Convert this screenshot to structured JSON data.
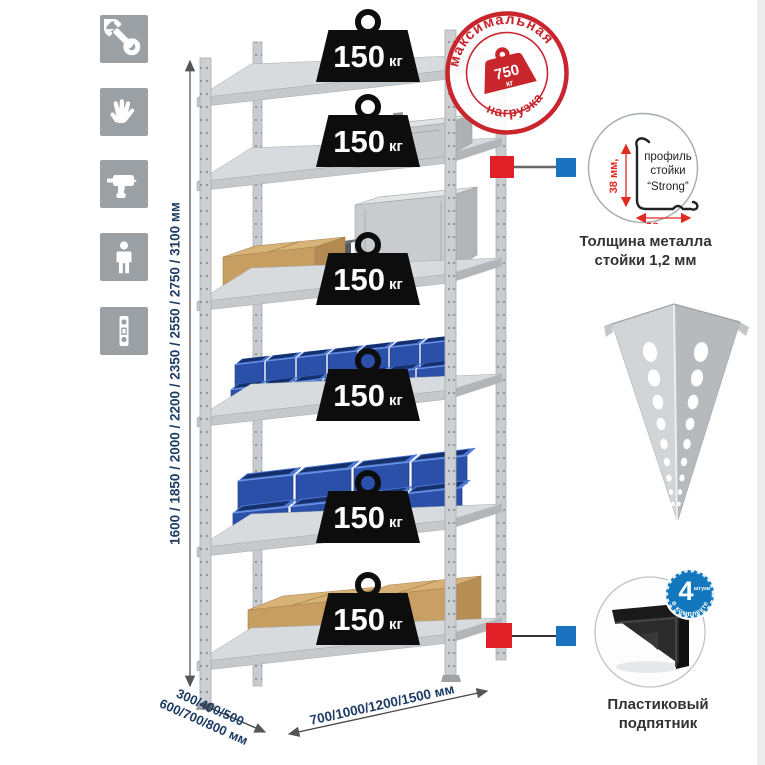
{
  "page": {
    "background": "#ffffff"
  },
  "sidebar": {
    "icons": [
      {
        "name": "wrench"
      },
      {
        "name": "work-gloves"
      },
      {
        "name": "drill"
      },
      {
        "name": "person"
      },
      {
        "name": "spirit-level"
      }
    ]
  },
  "rack": {
    "shelf_count": 6,
    "shelf_load_value": "150",
    "shelf_load_unit": "кг"
  },
  "max_load_stamp": {
    "arc_top": "максимальная",
    "arc_bottom": "нагрузка",
    "value": "750",
    "unit": "кг"
  },
  "dimensions": {
    "height": "1600 / 1850 / 2000 / 2200 / 2350 / 2550 / 2750 / 3100 мм",
    "depth_line1": "300/400/500",
    "depth_line2": "600/700/800 мм",
    "width": "700/1000/1200/1500 мм"
  },
  "profile_detail": {
    "label_line1": "профиль",
    "label_line2": "стойки",
    "label_line3": "“Strong”",
    "dim_vertical": "38 мм,",
    "dim_horizontal": "38 мм,",
    "caption_line1": "Толщина металла",
    "caption_line2": "стойки 1,2 мм"
  },
  "foot_detail": {
    "badge_value": "4",
    "badge_word": "штуки",
    "badge_arc": "в комплекте",
    "caption_line1": "Пластиковый",
    "caption_line2": "подпятник"
  },
  "colors": {
    "accent_red": "#c8262c",
    "accent_blue": "#1377bd",
    "dim_text": "#1e3c64",
    "icon_tile": "#9aa0a4",
    "bin_blue": "#2a50aa"
  }
}
